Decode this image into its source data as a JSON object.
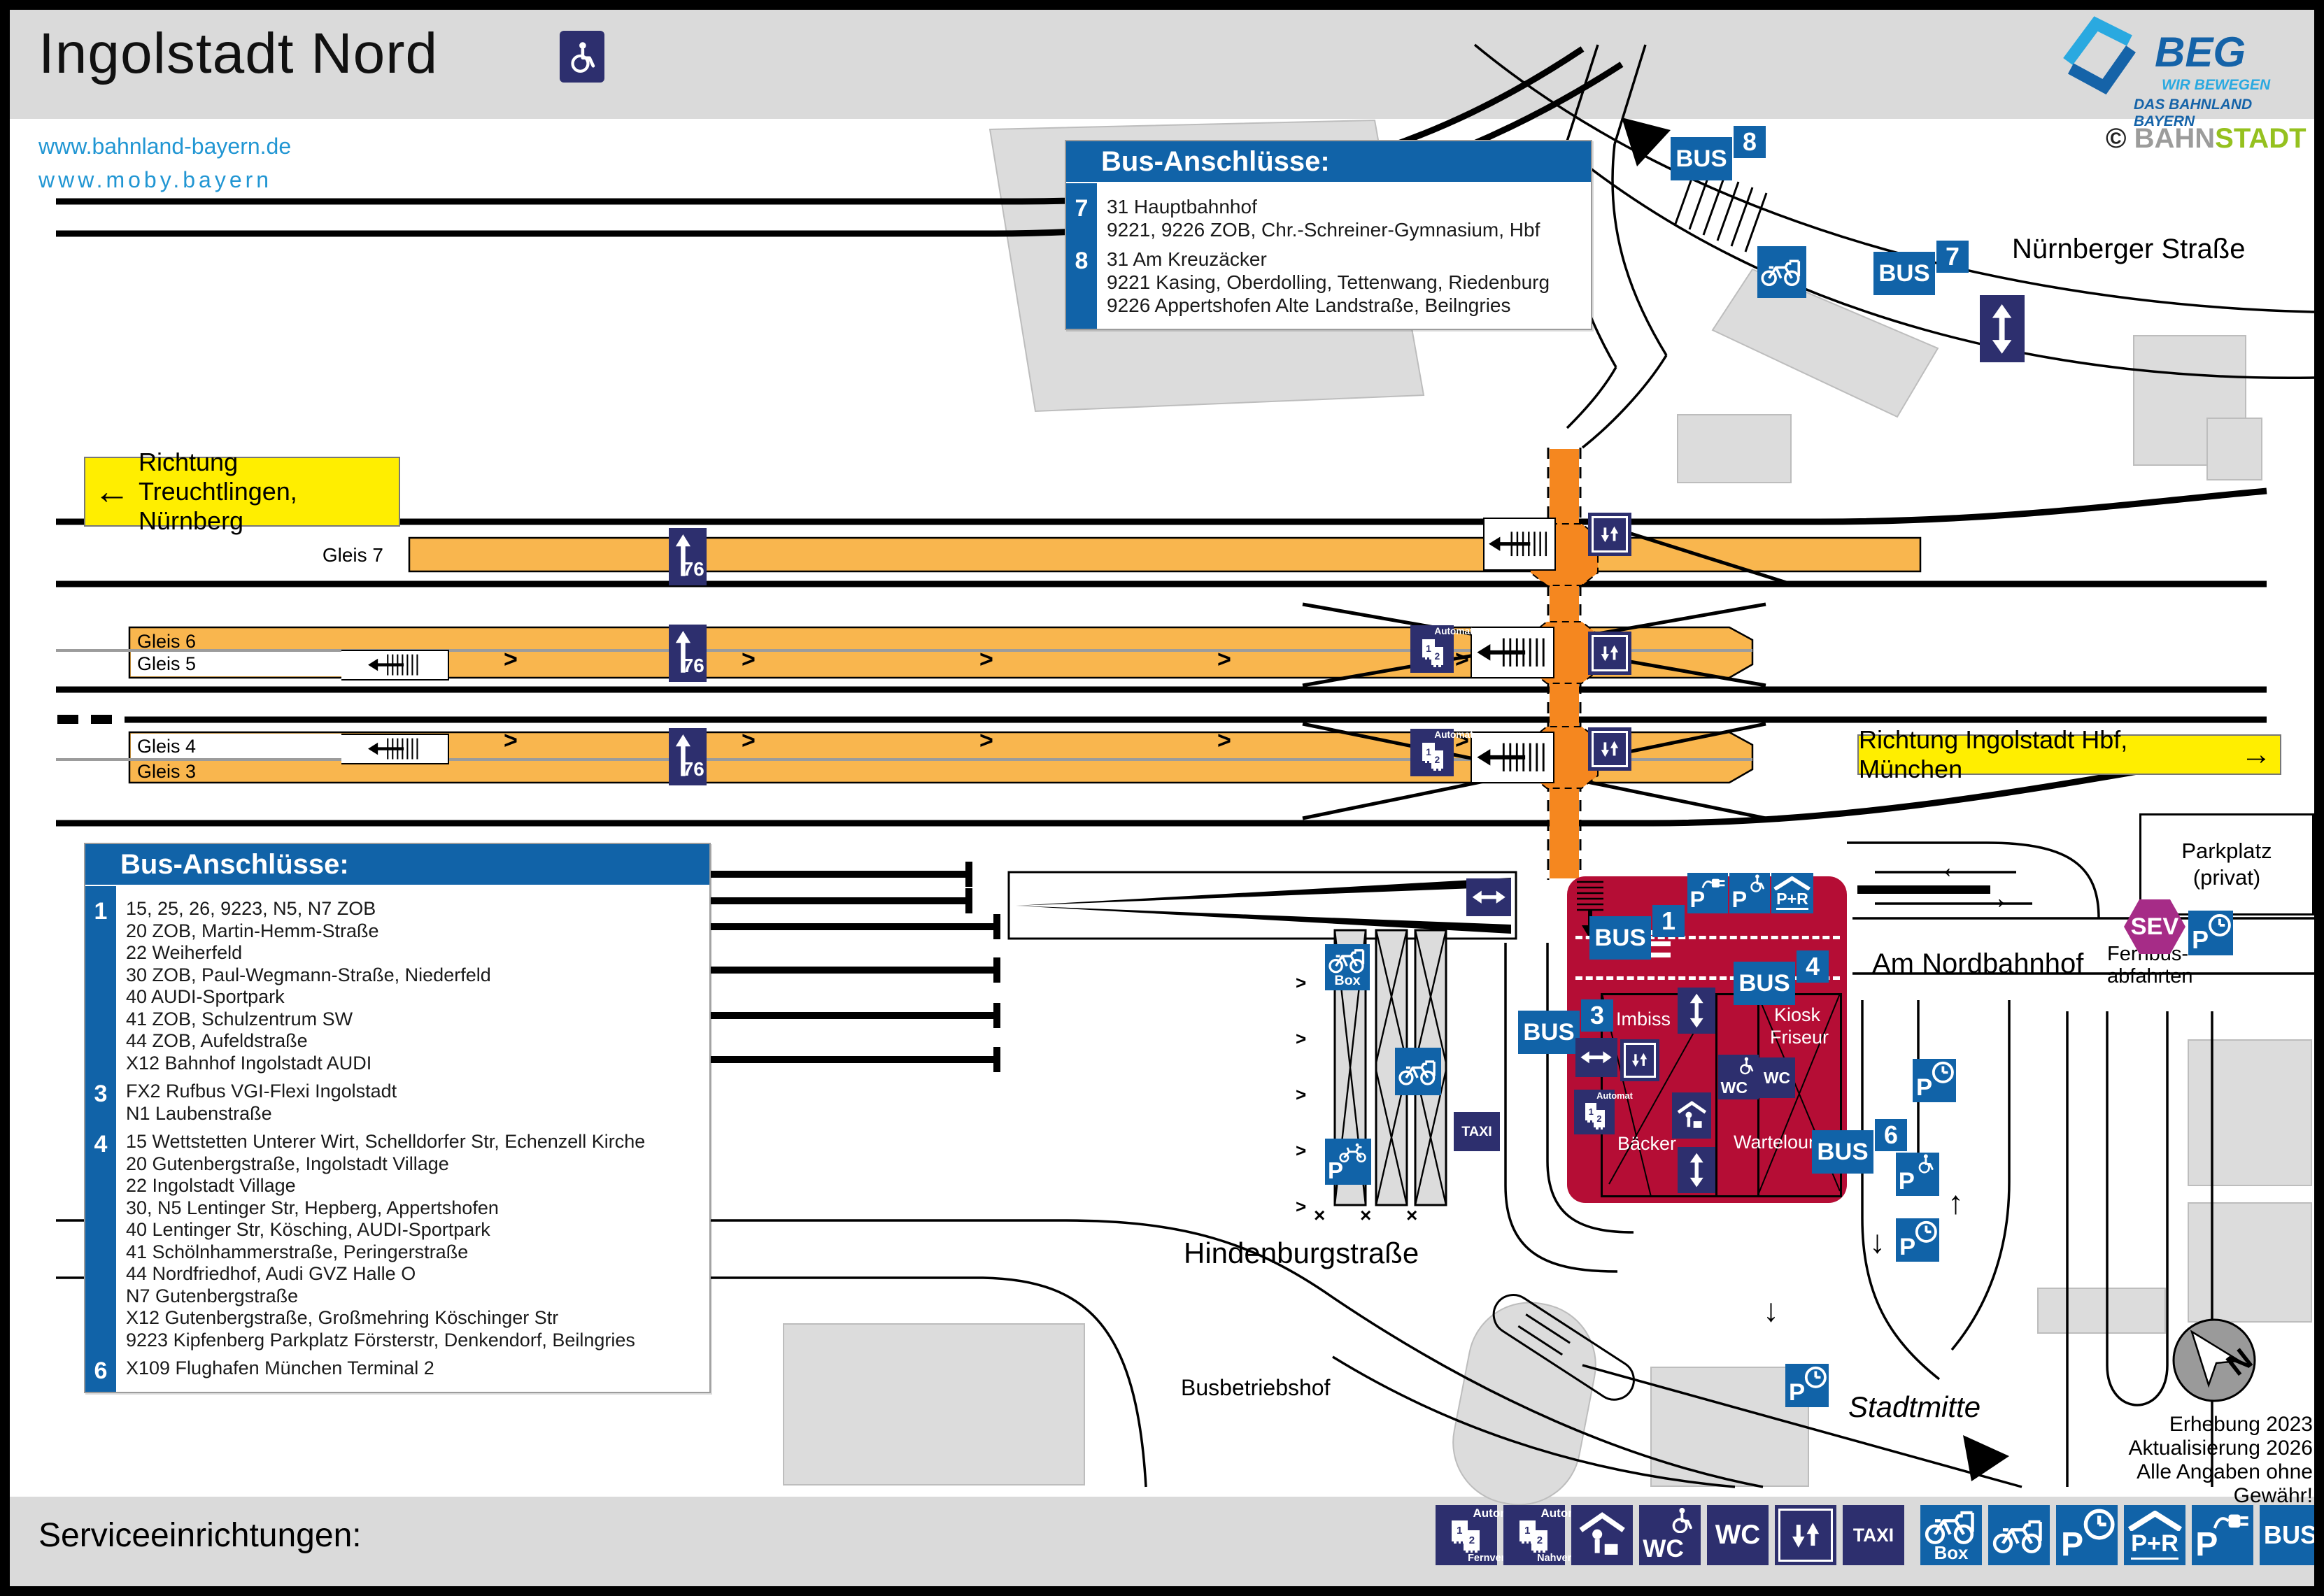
{
  "header": {
    "title": "Ingolstadt Nord",
    "link1": "www.bahnland-bayern.de",
    "link2": "www.moby.bayern",
    "credit_symbol": "©",
    "credit_part1": "BAHN",
    "credit_part2": "STADT"
  },
  "beg": {
    "name": "BEG",
    "tagline1": "WIR BEWEGEN",
    "tagline2": "DAS BAHNLAND BAYERN"
  },
  "direction_left": {
    "line1": "Richtung Treuchtlingen,",
    "line2": "Nürnberg",
    "arrow": "←"
  },
  "direction_right": {
    "text": "Richtung Ingolstadt Hbf, München",
    "arrow": "→"
  },
  "bus_boxes": [
    {
      "title": "Bus-Anschlüsse:",
      "groups": [
        {
          "stop": "7",
          "lines": [
            "31 Hauptbahnhof",
            "9221, 9226 ZOB, Chr.-Schreiner-Gymnasium, Hbf"
          ]
        },
        {
          "stop": "8",
          "lines": [
            "31 Am Kreuzäcker",
            "9221 Kasing, Oberdolling, Tettenwang, Riedenburg",
            "9226 Appertshofen Alte Landstraße, Beilngries"
          ]
        }
      ]
    },
    {
      "title": "Bus-Anschlüsse:",
      "groups": [
        {
          "stop": "1",
          "lines": [
            "15, 25, 26, 9223, N5, N7 ZOB",
            "20 ZOB, Martin-Hemm-Straße",
            "22 Weiherfeld",
            "30 ZOB, Paul-Wegmann-Straße, Niederfeld",
            "40 AUDI-Sportpark",
            "41 ZOB, Schulzentrum SW",
            "44 ZOB, Aufeldstraße",
            "X12 Bahnhof Ingolstadt AUDI"
          ]
        },
        {
          "stop": "3",
          "lines": [
            "FX2 Rufbus VGI-Flexi Ingolstadt",
            "N1 Laubenstraße"
          ]
        },
        {
          "stop": "4",
          "lines": [
            "15 Wettstetten Unterer Wirt, Schelldorfer Str, Echenzell Kirche",
            "20 Gutenbergstraße, Ingolstadt Village",
            "22 Ingolstadt Village",
            "30, N5 Lentinger Str, Hepberg, Appertshofen",
            "40 Lentinger Str, Kösching, AUDI-Sportpark",
            "41 Schölnhammerstraße, Peringerstraße",
            "44 Nordfriedhof, Audi GVZ Halle O",
            "N7 Gutenbergstraße",
            "X12 Gutenbergstraße, Großmehring Köschinger Str",
            "9223 Kipfenberg Parkplatz Försterstr, Denkendorf, Beilngries"
          ]
        },
        {
          "stop": "6",
          "lines": [
            "X109 Flughafen München Terminal 2"
          ]
        }
      ]
    }
  ],
  "platforms": {
    "gleis7": "Gleis 7",
    "gleis6": "Gleis 6",
    "gleis5": "Gleis 5",
    "gleis4": "Gleis 4",
    "gleis3": "Gleis 3",
    "height": "76"
  },
  "stops": {
    "s1": "1",
    "s3": "3",
    "s4": "4",
    "s6": "6",
    "s7": "7",
    "s8": "8"
  },
  "signs": {
    "bus": "BUS",
    "taxi": "TAXI",
    "wc": "WC",
    "p": "P",
    "pr": "P+R",
    "box": "Box",
    "automat": "Automat",
    "fernverkehr": "Fernverkehr",
    "nahverkehr": "Nahverkehr",
    "sev": "SEV",
    "ticket1": "1",
    "ticket2": "2"
  },
  "streets": {
    "nuernberger_strasse": "Nürnberger Straße",
    "am_nordbahnhof": "Am Nordbahnhof",
    "hindenburgstrasse": "Hindenburgstraße",
    "busbetriebshof": "Busbetriebshof",
    "stadtmitte": "Stadtmitte"
  },
  "building": {
    "imbiss": "Imbiss",
    "baecker": "Bäcker",
    "kiosk": "Kiosk",
    "friseur": "Friseur",
    "wartelounge": "Wartelounge"
  },
  "parking": {
    "parkplatz1": "Parkplatz",
    "parkplatz2": "(privat)",
    "fernbus1": "Fernbus-",
    "fernbus2": "abfahrten"
  },
  "legend": {
    "label": "Serviceeinrichtungen:"
  },
  "notes": {
    "line1": "Erhebung 2023",
    "line2": "Aktualisierung 2026",
    "line3": "Alle Angaben ohne Gewähr!"
  },
  "compass": {
    "north": "N"
  },
  "colors": {
    "blue": "#1163a8",
    "navy": "#2d2f6e",
    "platform_orange": "#f9b64e",
    "underpass_orange": "#f5871f",
    "building_red": "#b50d35",
    "direction_yellow": "#ffee00",
    "sev_magenta": "#a62c87",
    "building_grey": "#dcdcdc",
    "link_blue": "#2196d3",
    "beg_lightblue": "#2aa9e0",
    "beg_darkblue": "#1563a8",
    "bahn_grey": "#9c9c9b",
    "stadt_green": "#95c11f"
  }
}
